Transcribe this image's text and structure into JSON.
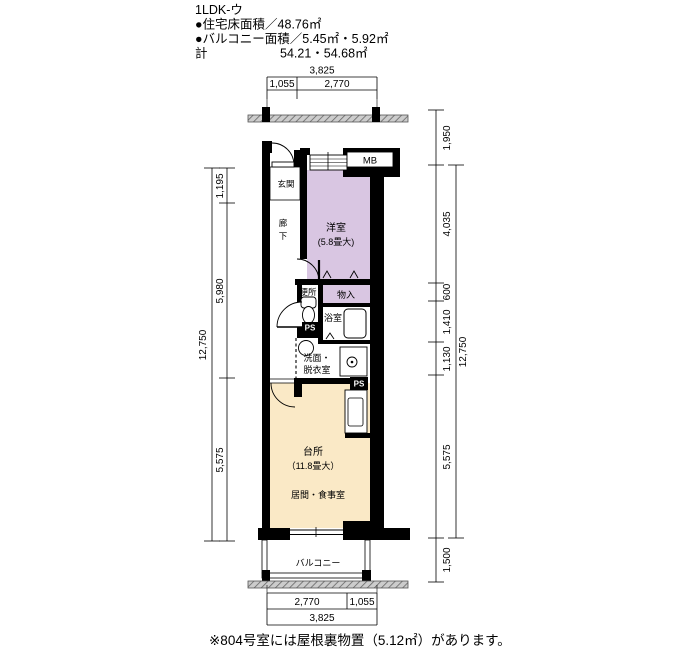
{
  "header": {
    "plan_type": "1LDK-ウ",
    "floor_area_line": "●住宅床面積／48.76㎡",
    "balcony_area_line": "●バルコニー面積／5.45㎡・5.92㎡",
    "total_label": "計",
    "total_value": "54.21・54.68㎡"
  },
  "rooms": {
    "genkan": "玄関",
    "rouka_char1": "廊",
    "rouka_char2": "下",
    "yoshitsu": "洋室",
    "yoshitsu_size": "(5.8畳大)",
    "benjo": "便所",
    "monoire": "物入",
    "yokushitsu": "浴室",
    "senmen_line1": "洗面・",
    "senmen_line2": "脱衣室",
    "daidokoro": "台所",
    "daidokoro_size": "（11.8畳大）",
    "ima_shokuji": "居間・食事室",
    "balcony": "バルコニー",
    "mb": "MB",
    "ps": "PS"
  },
  "dimensions": {
    "top_total": "3,825",
    "top_segments": [
      "1,055",
      "2,770"
    ],
    "bottom_segments": [
      "2,770",
      "1,055"
    ],
    "bottom_total": "3,825",
    "left_total": "12,750",
    "left_segments": [
      "1,195",
      "5,980",
      "5,575"
    ],
    "right_segments": [
      "1,950",
      "4,035",
      "600",
      "1,410",
      "1,130",
      "5,575",
      "1,500"
    ],
    "right_total": "12,750"
  },
  "note": "※804号室には屋根裏物置（5.12㎡）があります。",
  "colors": {
    "room_purple": "#d9c6e2",
    "living_cream": "#fae9c6",
    "wall": "#000000"
  }
}
